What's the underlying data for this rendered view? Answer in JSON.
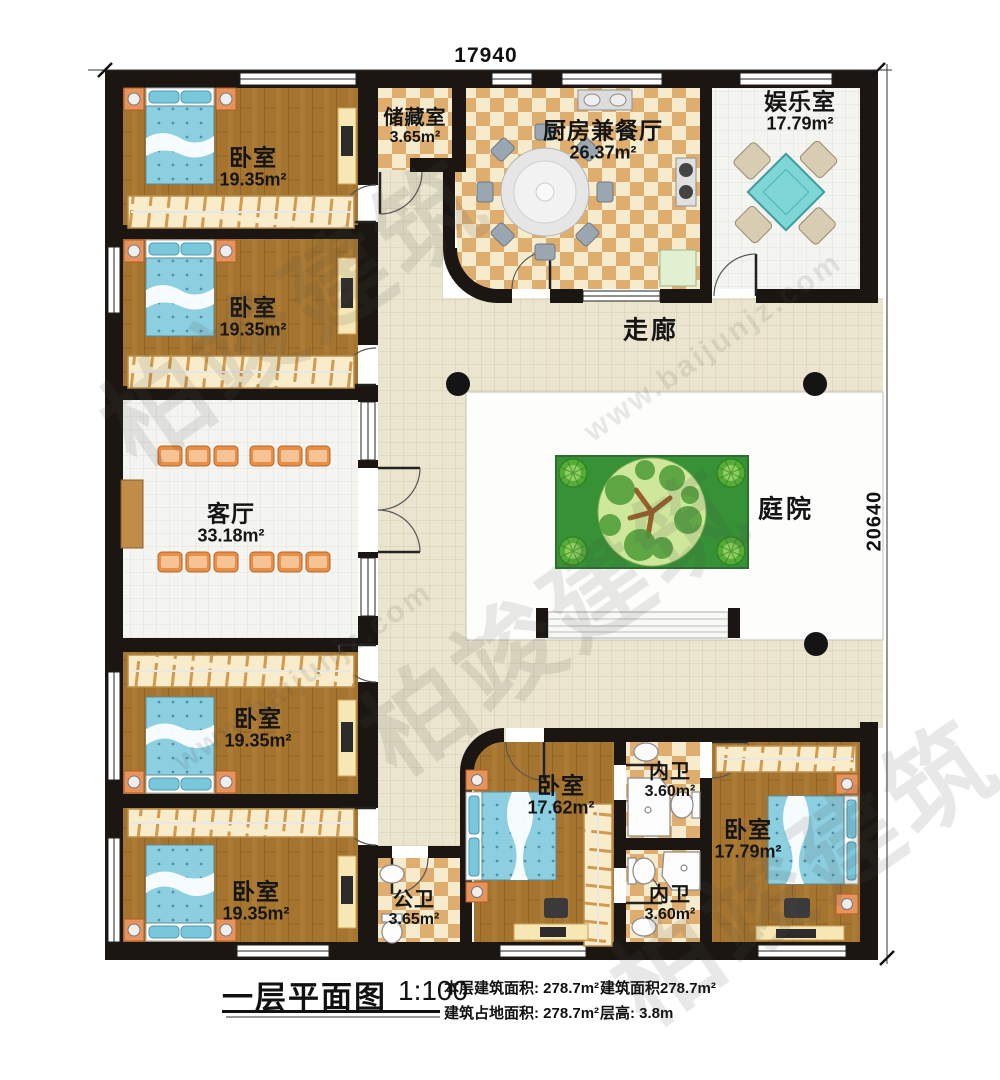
{
  "dimensions": {
    "top": "17940",
    "right": "20640"
  },
  "rooms": {
    "bedroom_top_1": {
      "name": "卧室",
      "area": "19.35m²"
    },
    "bedroom_top_2": {
      "name": "卧室",
      "area": "19.35m²"
    },
    "storage": {
      "name": "储藏室",
      "area": "3.65m²"
    },
    "kitchen_dining": {
      "name": "厨房兼餐厅",
      "area": "26.37m²"
    },
    "entertainment": {
      "name": "娱乐室",
      "area": "17.79m²"
    },
    "corridor": {
      "name": "走廊"
    },
    "living": {
      "name": "客厅",
      "area": "33.18m²"
    },
    "courtyard": {
      "name": "庭院"
    },
    "bedroom_bottom_1": {
      "name": "卧室",
      "area": "19.35m²"
    },
    "bedroom_bottom_2": {
      "name": "卧室",
      "area": "19.35m²"
    },
    "public_bath": {
      "name": "公卫",
      "area": "3.65m²"
    },
    "bedroom_middle": {
      "name": "卧室",
      "area": "17.62m²"
    },
    "ensuite_top": {
      "name": "内卫",
      "area": "3.60m²"
    },
    "bedroom_right": {
      "name": "卧室",
      "area": "17.79m²"
    },
    "ensuite_bottom": {
      "name": "内卫",
      "area": "3.60m²"
    }
  },
  "title_block": {
    "title": "一层平面图",
    "scale": "1:100",
    "floor_area": "本层建筑面积: 278.7m²",
    "footprint_area": "建筑占地面积: 278.7m²",
    "total_area": "建筑面积278.7m²",
    "storey_height": "层高: 3.8m"
  },
  "watermark": {
    "brand": "柏竣建筑",
    "url": "www.baijunjz.com"
  },
  "colors": {
    "wall": "#1b1612",
    "wood": "#a5742f",
    "checker_dark": "#dfae6f",
    "checker_light": "#f6ebcd",
    "tile_beige": "#ebe5cf",
    "tile_white": "#f4f4f1",
    "bed_blue": "#8ccfe0",
    "chair_orange": "#e78f45",
    "grass": "#379136",
    "mahjong_teal": "#7fd6d6",
    "nightstand_orange": "#e8935c"
  }
}
